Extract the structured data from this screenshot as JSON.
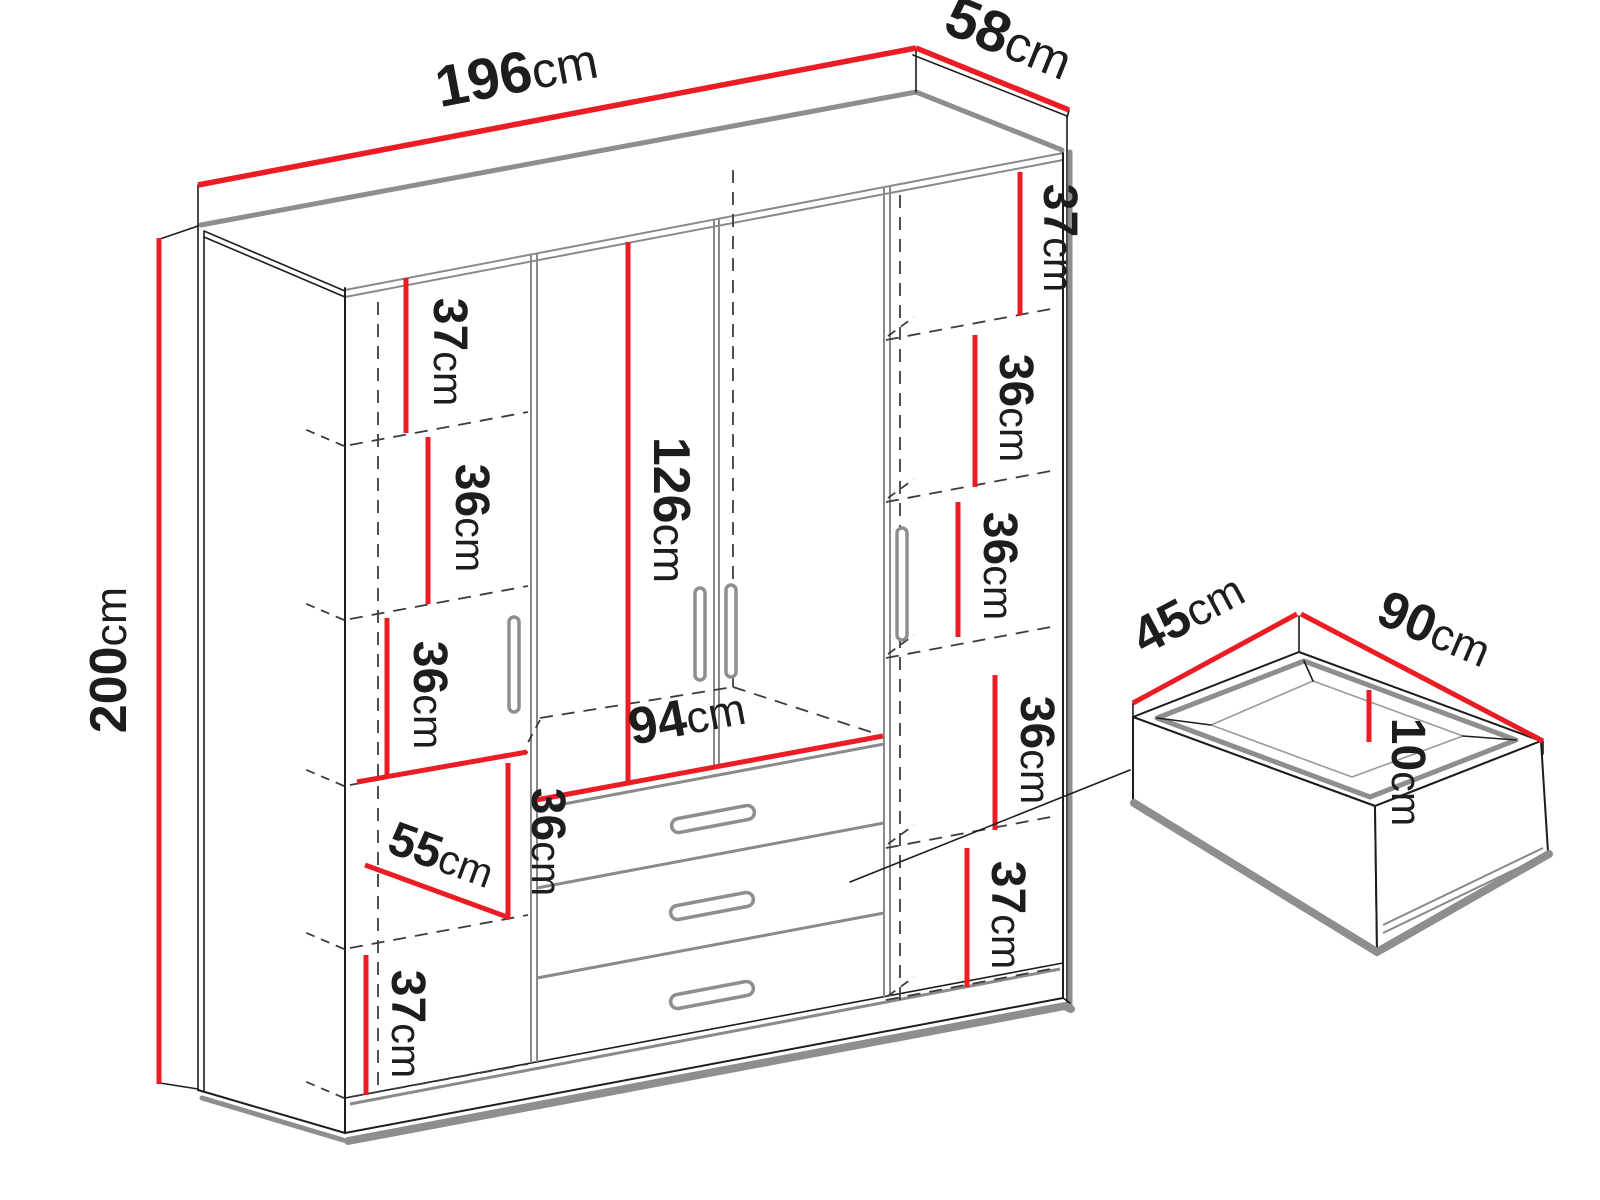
{
  "diagram": {
    "type": "furniture-dimension-diagram",
    "subject": "four-door wardrobe with drawers, exploded drawer detail",
    "accent_color": "#ec1c24",
    "outline_color": "#1d1d1b",
    "shadow_color": "#8e8e8e",
    "dims": {
      "width": {
        "value": "196",
        "unit": "cm"
      },
      "depth": {
        "value": "58",
        "unit": "cm"
      },
      "height": {
        "value": "200",
        "unit": "cm"
      },
      "opening_height": {
        "value": "126",
        "unit": "cm"
      },
      "opening_width": {
        "value": "94",
        "unit": "cm"
      },
      "left_col": {
        "s1": {
          "value": "37",
          "unit": "cm"
        },
        "s2": {
          "value": "36",
          "unit": "cm"
        },
        "s3": {
          "value": "36",
          "unit": "cm"
        },
        "s4": {
          "value": "36",
          "unit": "cm"
        },
        "inner_width": {
          "value": "55",
          "unit": "cm"
        },
        "s5": {
          "value": "37",
          "unit": "cm"
        }
      },
      "right_col": {
        "s1": {
          "value": "37",
          "unit": "cm"
        },
        "s2": {
          "value": "36",
          "unit": "cm"
        },
        "s3": {
          "value": "36",
          "unit": "cm"
        },
        "s4": {
          "value": "36",
          "unit": "cm"
        },
        "s5": {
          "value": "37",
          "unit": "cm"
        }
      },
      "drawer": {
        "depth": {
          "value": "45",
          "unit": "cm"
        },
        "width": {
          "value": "90",
          "unit": "cm"
        },
        "height": {
          "value": "10",
          "unit": "cm"
        }
      }
    }
  }
}
